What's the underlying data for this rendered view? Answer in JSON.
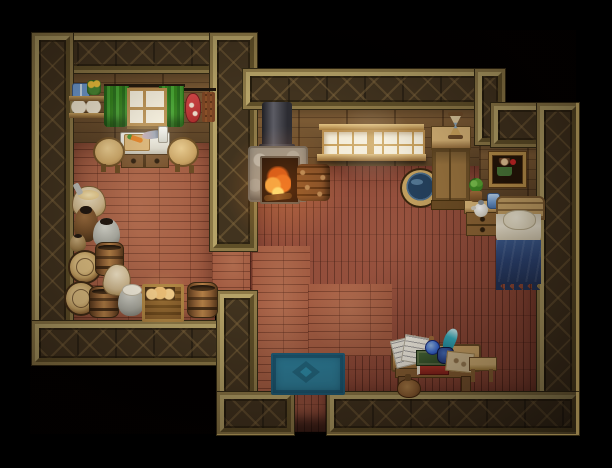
{
  "app": {
    "type": "game-screenshot",
    "title": "Top-down RPG cottage interior",
    "canvas": {
      "width": 612,
      "height": 468
    }
  },
  "palette": {
    "background": "#000000",
    "wall_timber": "#41331f",
    "wall_trim_gold": "#b5a267",
    "back_wall": "#7b5a34",
    "floor_light": "#a25c42",
    "floor_red": "#8c4736",
    "rug_teal": "#2d7d98",
    "blanket_navy": "#2c4576",
    "curtain_green": "#3f8f2f",
    "fire_orange": "#e8641e",
    "window_glow": "#f3ecd8"
  },
  "rooms": {
    "kitchen": {
      "label": "Kitchen and storage room"
    },
    "main": {
      "label": "Main living room with bed alcove"
    },
    "doorway": {
      "label": "Entrance doorway at bottom wall"
    }
  },
  "objects": {
    "shelf": {
      "label": "Wall shelf with blue jars, flowers and flour sacks"
    },
    "curtainLeft": {
      "label": "Green curtain (left panel)"
    },
    "curtainRight": {
      "label": "Green curtain (right panel)"
    },
    "kitchenWindow": {
      "label": "Small four-pane window"
    },
    "meatRack": {
      "label": "Hanging rack with meat and sausages"
    },
    "counter": {
      "label": "Kitchen counter with cutting board, carrot and fish"
    },
    "stoolLeft": {
      "label": "Round stool"
    },
    "stoolRight": {
      "label": "Round stool"
    },
    "grainSack": {
      "label": "Open grain sack with scoop"
    },
    "jarDark": {
      "label": "Large brown ceramic jar"
    },
    "jarGrey": {
      "label": "Grey ceramic pot"
    },
    "jarSmall": {
      "label": "Small jar"
    },
    "barrelTop1": {
      "label": "Barrel (top view)"
    },
    "barrel1": {
      "label": "Wooden barrel"
    },
    "barrelTop2": {
      "label": "Barrel (top view)"
    },
    "barrel2": {
      "label": "Wooden barrel"
    },
    "sackPlain": {
      "label": "Flour sack"
    },
    "potCloth": {
      "label": "Grey pot covered with cloth"
    },
    "breadCrate": {
      "label": "Crate of bread loaves"
    },
    "barrel3": {
      "label": "Wooden barrel"
    },
    "stovepipe": {
      "label": "Iron stove pipe"
    },
    "fireplace": {
      "label": "Stone fireplace with burning fire"
    },
    "firewood": {
      "label": "Stacked firewood"
    },
    "bigWindow": {
      "label": "Wide lattice window, lit"
    },
    "waterTub": {
      "label": "Wooden tub filled with water"
    },
    "cabinet": {
      "label": "Tall wooden cabinet"
    },
    "hourglass": {
      "label": "Hourglass on cabinet"
    },
    "picture": {
      "label": "Framed portrait on wall"
    },
    "nightstand": {
      "label": "Nightstand with drawers"
    },
    "plant": {
      "label": "Potted plant"
    },
    "teapot": {
      "label": "White teapot"
    },
    "blueGlass": {
      "label": "Blue glass cup"
    },
    "bed": {
      "label": "Bed with navy blanket and pillow"
    },
    "rug": {
      "label": "Teal patterned door mat"
    },
    "desk": {
      "label": "Writing desk"
    },
    "papers": {
      "label": "Loose handwritten papers"
    },
    "potion": {
      "label": "Blue potion bottle"
    },
    "books": {
      "label": "Stack of books"
    },
    "quill": {
      "label": "Teal quill feather"
    },
    "inkpot": {
      "label": "Ink pot"
    },
    "parchment": {
      "label": "Parchment sheet"
    },
    "pouch": {
      "label": "Leather pouch on floor"
    },
    "deskStool": {
      "label": "Small wooden stool"
    }
  }
}
